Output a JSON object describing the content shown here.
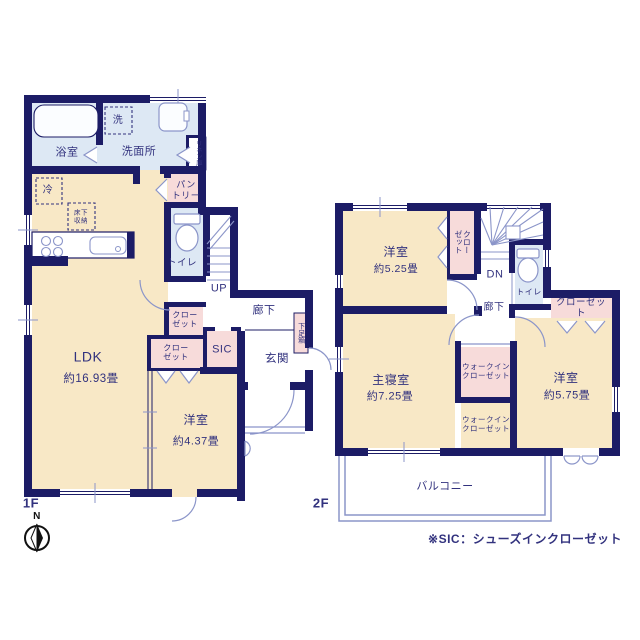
{
  "palette": {
    "wall": "#1c1c66",
    "room_cream": "#f8e8c6",
    "room_blue": "#dde8f4",
    "closet_pink": "#f7dbda",
    "fixture_line": "#8b95c9",
    "text_navy": "#32327e"
  },
  "floor1": {
    "floor_label": "1F",
    "ldk": {
      "name": "LDK",
      "size": "約16.93畳"
    },
    "bedroom": {
      "name": "洋室",
      "size": "約4.37畳"
    },
    "bathroom": "浴室",
    "washroom": "洗面所",
    "washer": "洗",
    "linen": "リネン庫",
    "fridge": "冷",
    "pantry": "パン\nトリー",
    "toilet": "トイレ",
    "underfloor": "床下\n収納",
    "stairs_up": "UP",
    "hallway": "廊下",
    "shoe_box": "下足箱",
    "closet_a": "クロー\nゼット",
    "closet_b": "クロー\nゼット",
    "sic": "SIC",
    "entrance": "玄関"
  },
  "floor2": {
    "floor_label": "2F",
    "bedroom_a": {
      "name": "洋室",
      "size": "約5.25畳"
    },
    "closet_vertical": "クロー\nゼット",
    "stairs_down": "DN",
    "toilet": "トイレ",
    "hallway": "廊下",
    "closet": "クローゼット",
    "master": {
      "name": "主寝室",
      "size": "約7.25畳"
    },
    "wic_a": "ウォークイン\nクローゼット",
    "wic_b": "ウォークイン\nクローゼット",
    "bedroom_b": {
      "name": "洋室",
      "size": "約5.75畳"
    },
    "balcony": "バルコニー"
  },
  "compass": {
    "north": "N"
  },
  "footnote": "※SIC：シューズインクローゼット"
}
